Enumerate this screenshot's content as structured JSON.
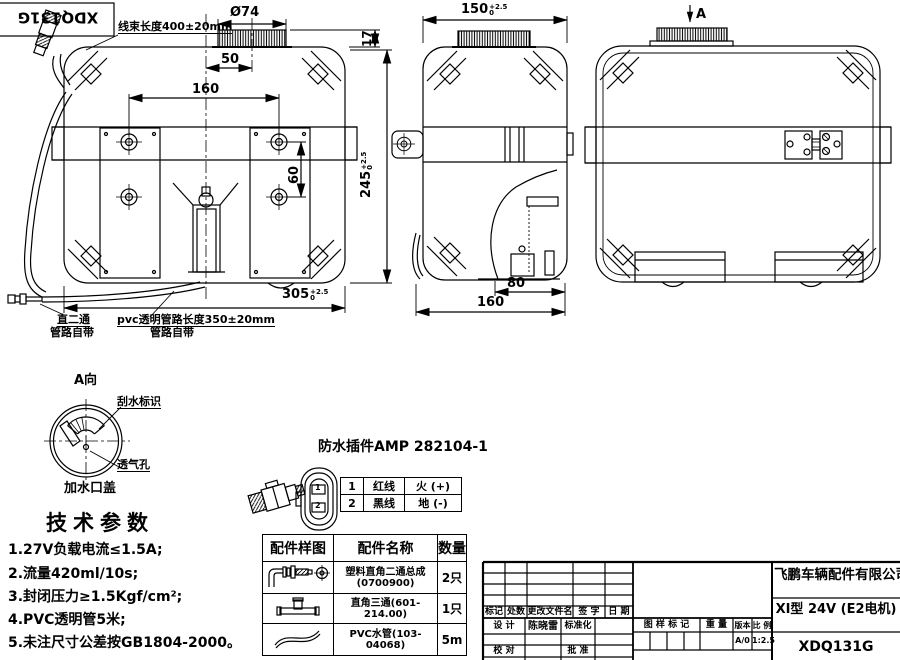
{
  "tag": {
    "model_label": "XDQ131G"
  },
  "annotations": {
    "harness_length": "线束长度400±20mm",
    "straight_fitting_line1": "直二通",
    "straight_fitting_line2": "管路自带",
    "pvc_pipe_line1": "pvc透明管路长度350±20mm",
    "pvc_pipe_line2": "管路自带",
    "view_a_arrow": "A"
  },
  "dims": {
    "cap_diameter": "Ø74",
    "front_cap_offset": "50",
    "front_hole_span": "160",
    "front_hole_vspan": "60",
    "front_cap_height": "17",
    "front_height": "245",
    "front_height_tol_up": "+2.5",
    "front_height_tol_dn": "0",
    "front_width": "305",
    "front_width_tol_up": "+2.5",
    "front_width_tol_dn": "0",
    "side_width": "150",
    "side_width_tol_up": "+2.5",
    "side_width_tol_dn": "0",
    "side_pump_offset": "80",
    "side_depth": "160"
  },
  "detail_a": {
    "title": "A向",
    "wiper_label": "刮水标识",
    "vent_label": "透气孔",
    "cap_label": "加水口盖"
  },
  "tech_params": {
    "title": "技术参数",
    "items": [
      "1.27V负载电流≤1.5A;",
      "2.流量420ml/10s;",
      "3.封闭压力≥1.5Kgf/cm²;",
      "4.PVC透明管5米;",
      "5.未注尺寸公差按GB1804-2000。"
    ]
  },
  "connector": {
    "title": "防水插件AMP 282104-1",
    "pins": [
      {
        "no": "1",
        "wire": "红线",
        "role": "火 (+)"
      },
      {
        "no": "2",
        "wire": "黑线",
        "role": "地 (-)"
      }
    ]
  },
  "parts_table": {
    "headers": [
      "配件样图",
      "配件名称",
      "数量"
    ],
    "rows": [
      {
        "icon": "elbow-fitting-icon",
        "name_line1": "塑料直角二通总成",
        "name_line2": "(0700900)",
        "qty": "2只"
      },
      {
        "icon": "tee-fitting-icon",
        "name_line1": "直角三通(601-214.00)",
        "name_line2": "",
        "qty": "1只"
      },
      {
        "icon": "pvc-tube-icon",
        "name_line1": "PVC水管(103-04068)",
        "name_line2": "",
        "qty": "5m"
      }
    ]
  },
  "title_block": {
    "company": "飞鹏车辆配件有限公司",
    "product": "XI型 24V (E2电机)",
    "drawing_no": "XDQ131G",
    "labels": {
      "mark": "标记",
      "count": "处数",
      "changed_file": "更改文件名",
      "signature": "签 字",
      "date": "日 期",
      "design": "设 计",
      "designer": "陈晓雷",
      "standardization": "标准化",
      "check": "校 对",
      "approve": "批 准",
      "drawing_mark": "图 样 标 记",
      "weight": "重 量",
      "version": "版本",
      "scale": "比 例",
      "version_value": "A/0",
      "scale_value": "1:2.5"
    }
  }
}
